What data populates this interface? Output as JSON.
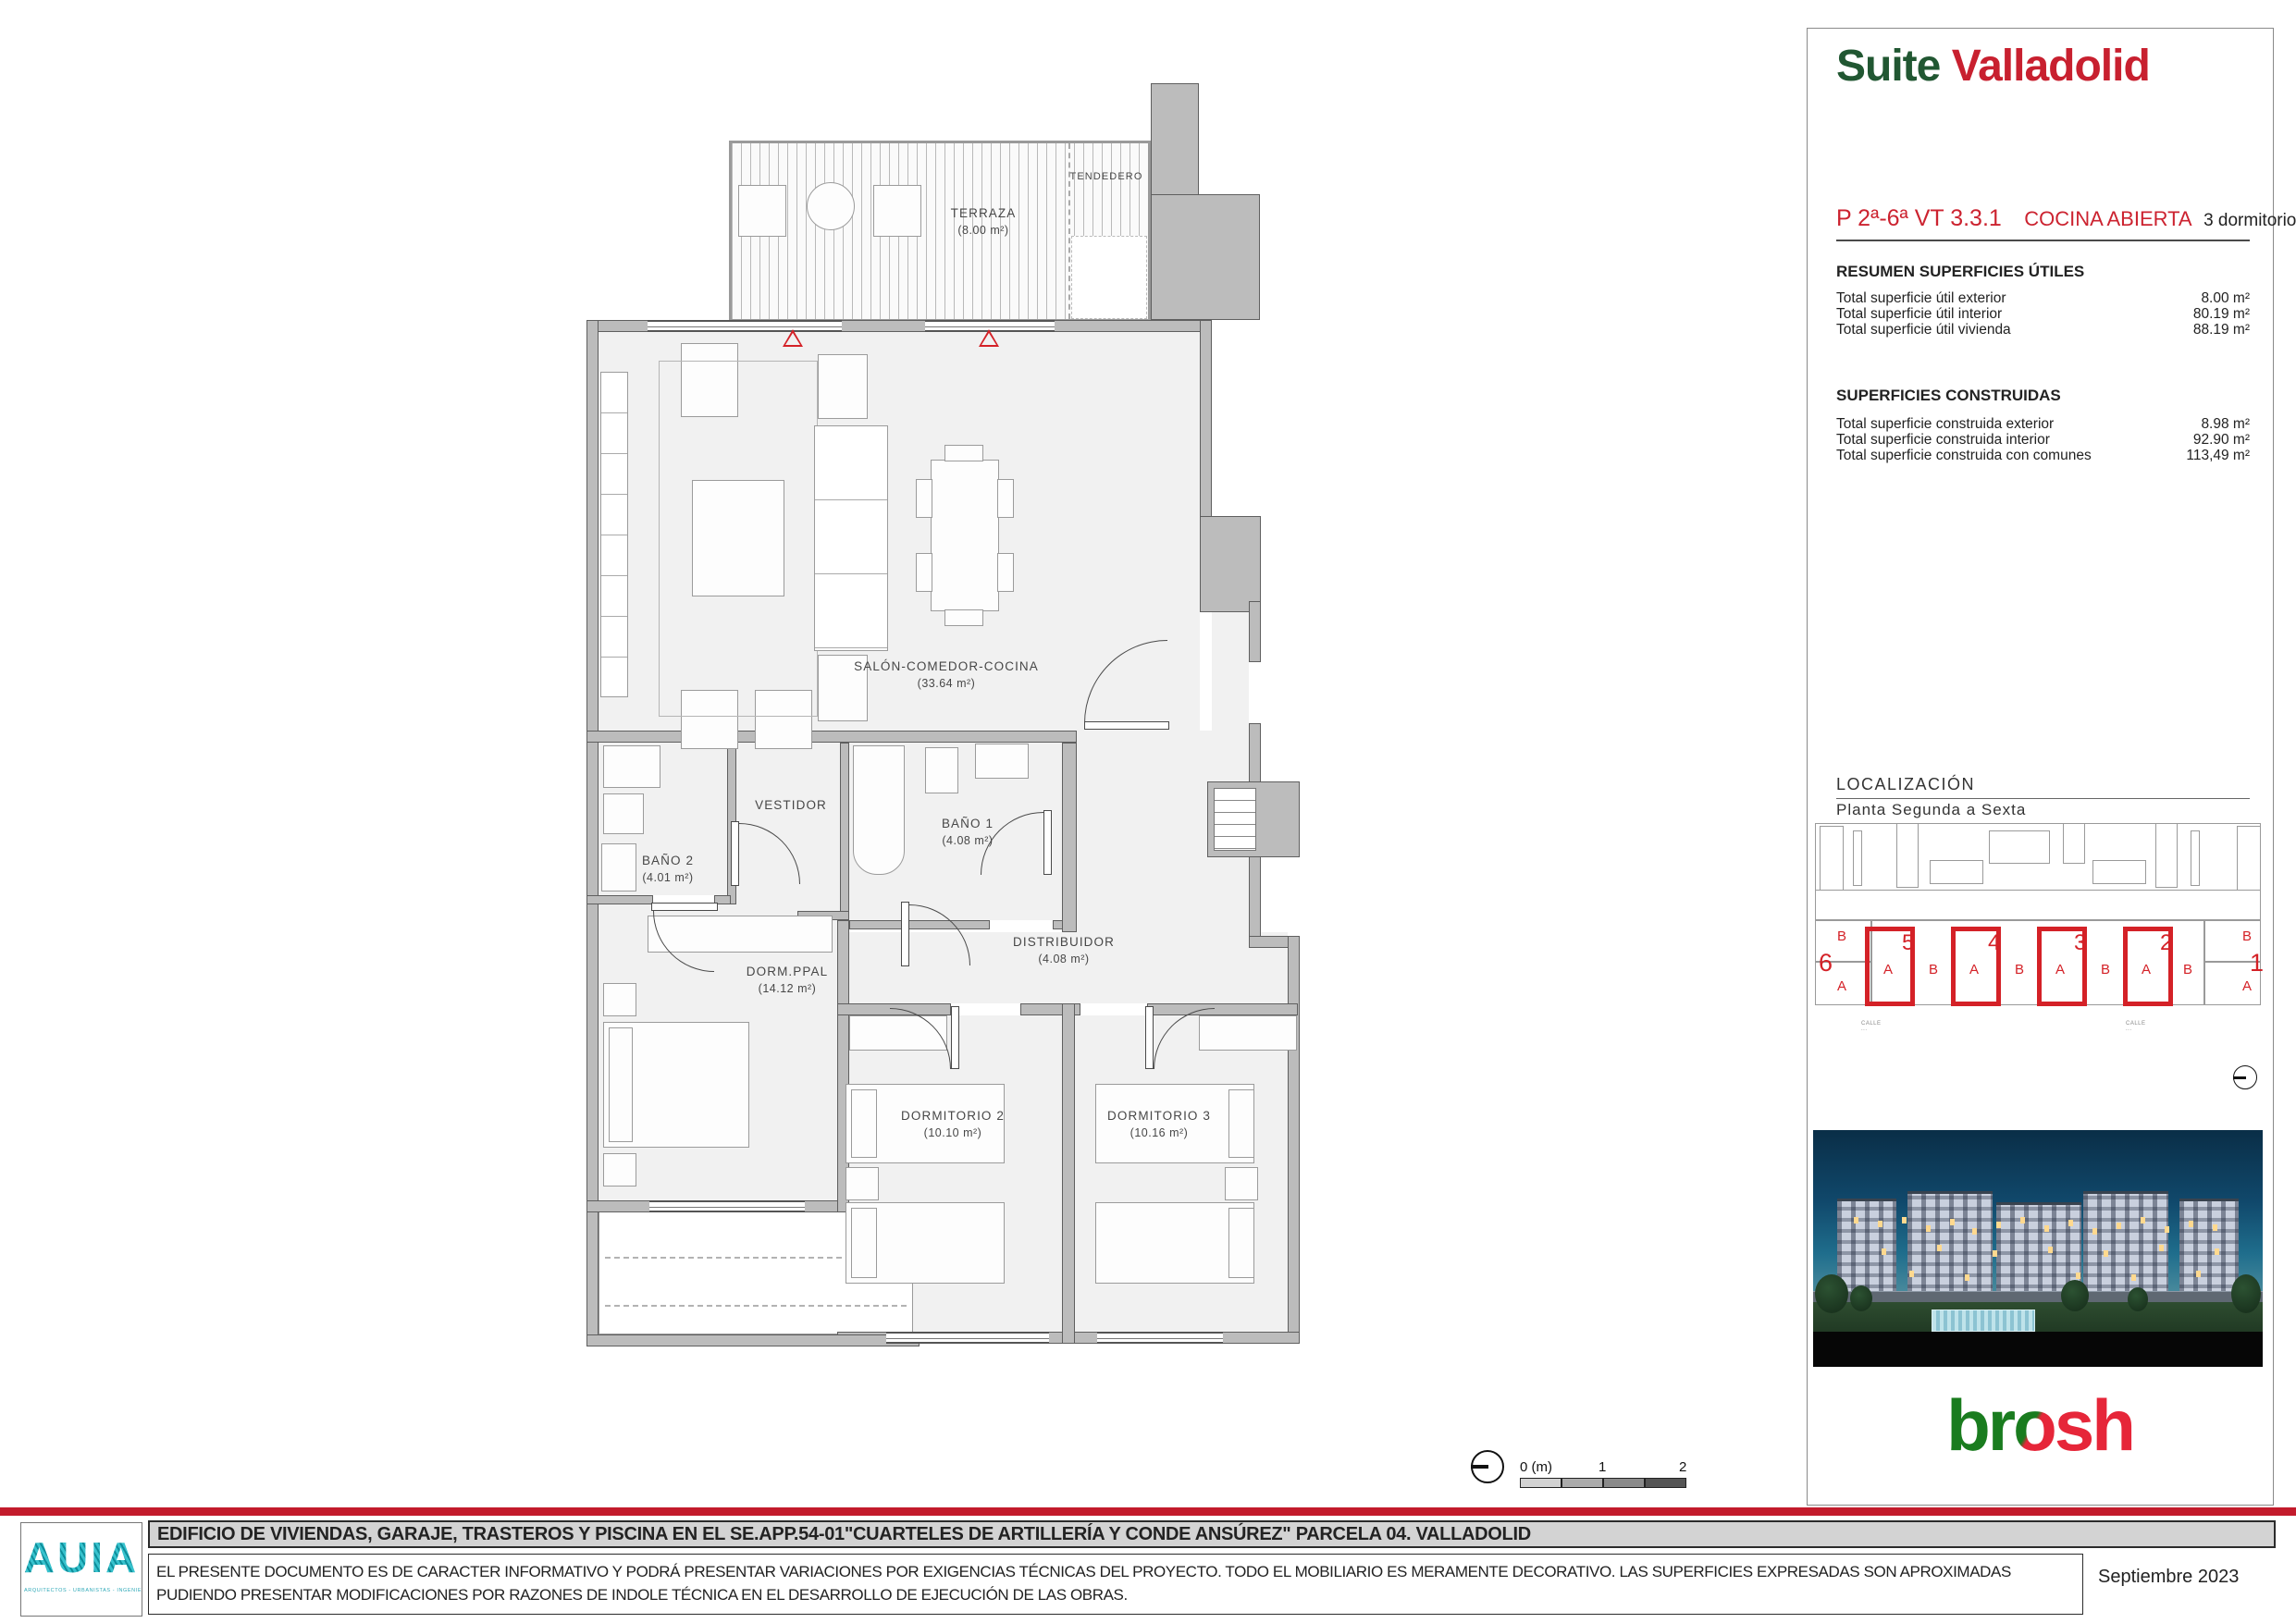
{
  "brand": {
    "suite": "Suite",
    "city": "Valladolid"
  },
  "unit": {
    "code": "P 2ª-6ª VT 3.3.1",
    "kitchen": "COCINA ABIERTA",
    "bedrooms": "3 dormitorios"
  },
  "areas": {
    "useful": {
      "title": "RESUMEN SUPERFICIES ÚTILES",
      "rows": [
        {
          "label": "Total superficie útil exterior",
          "value": "8.00 m²"
        },
        {
          "label": "Total superficie útil interior",
          "value": "80.19 m²"
        },
        {
          "label": "Total superficie útil vivienda",
          "value": "88.19 m²"
        }
      ]
    },
    "built": {
      "title": "SUPERFICIES CONSTRUIDAS",
      "rows": [
        {
          "label": "Total superficie construida exterior",
          "value": "8.98 m²"
        },
        {
          "label": "Total superficie construida interior",
          "value": "92.90 m²"
        },
        {
          "label": "Total superficie construida con comunes",
          "value": "113,49 m²"
        }
      ]
    }
  },
  "localization": {
    "title": "LOCALIZACIÓN",
    "subtitle": "Planta Segunda a Sexta",
    "left": [
      "B",
      "6",
      "A"
    ],
    "right": [
      "B",
      "1",
      "A"
    ],
    "letters": [
      "A",
      "B",
      "A",
      "B",
      "A",
      "B",
      "A",
      "B"
    ],
    "portals": [
      "5",
      "4",
      "3",
      "2"
    ],
    "street": "CALLE ..."
  },
  "plan": {
    "rooms": {
      "terraza": {
        "name": "TERRAZA",
        "area": "(8.00 m²)"
      },
      "tendedero": {
        "name": "TENDEDERO"
      },
      "salon": {
        "name": "SALÓN-COMEDOR-COCINA",
        "area": "(33.64 m²)"
      },
      "vestidor": {
        "name": "VESTIDOR"
      },
      "bano1": {
        "name": "BAÑO 1",
        "area": "(4.08 m²)"
      },
      "bano2": {
        "name": "BAÑO 2",
        "area": "(4.01 m²)"
      },
      "distribuidor": {
        "name": "DISTRIBUIDOR",
        "area": "(4.08 m²)"
      },
      "dormppal": {
        "name": "DORM.PPAL",
        "area": "(14.12 m²)"
      },
      "dorm2": {
        "name": "DORMITORIO 2",
        "area": "(10.10 m²)"
      },
      "dorm3": {
        "name": "DORMITORIO 3",
        "area": "(10.16 m²)"
      }
    }
  },
  "scalebar": {
    "zero": "0 (m)",
    "one": "1",
    "two": "2"
  },
  "logo": {
    "br": "br",
    "o": "o",
    "sh": "sh"
  },
  "footer": {
    "project_title": "EDIFICIO DE VIVIENDAS, GARAJE, TRASTEROS Y PISCINA EN EL SE.APP.54-01\"CUARTELES DE ARTILLERÍA Y CONDE ANSÚREZ\" PARCELA 04. VALLADOLID",
    "disclaimer_line1": "EL PRESENTE DOCUMENTO ES DE CARACTER INFORMATIVO Y PODRÁ PRESENTAR VARIACIONES POR EXIGENCIAS TÉCNICAS DEL PROYECTO. TODO EL MOBILIARIO ES MERAMENTE DECORATIVO. LAS SUPERFICIES EXPRESADAS SON APROXIMADAS",
    "disclaimer_line2": "PUDIENDO PRESENTAR MODIFICACIONES POR RAZONES DE INDOLE TÉCNICA EN EL DESARROLLO DE EJECUCIÓN DE LAS OBRAS.",
    "date": "Septiembre 2023",
    "auia_name": "AUIA",
    "auia_tagline": "ARQUITECTOS - URBANISTAS - INGENIEROS - ASOCIADOS"
  },
  "colors": {
    "brand_green": "#215732",
    "brand_red": "#c8202f",
    "brosh_green": "#1a7c1f",
    "brosh_red": "#e62639",
    "footer_bar_red": "#c31b2c",
    "plan_red": "#d42127",
    "auia_teal": "#2fa9b8"
  }
}
